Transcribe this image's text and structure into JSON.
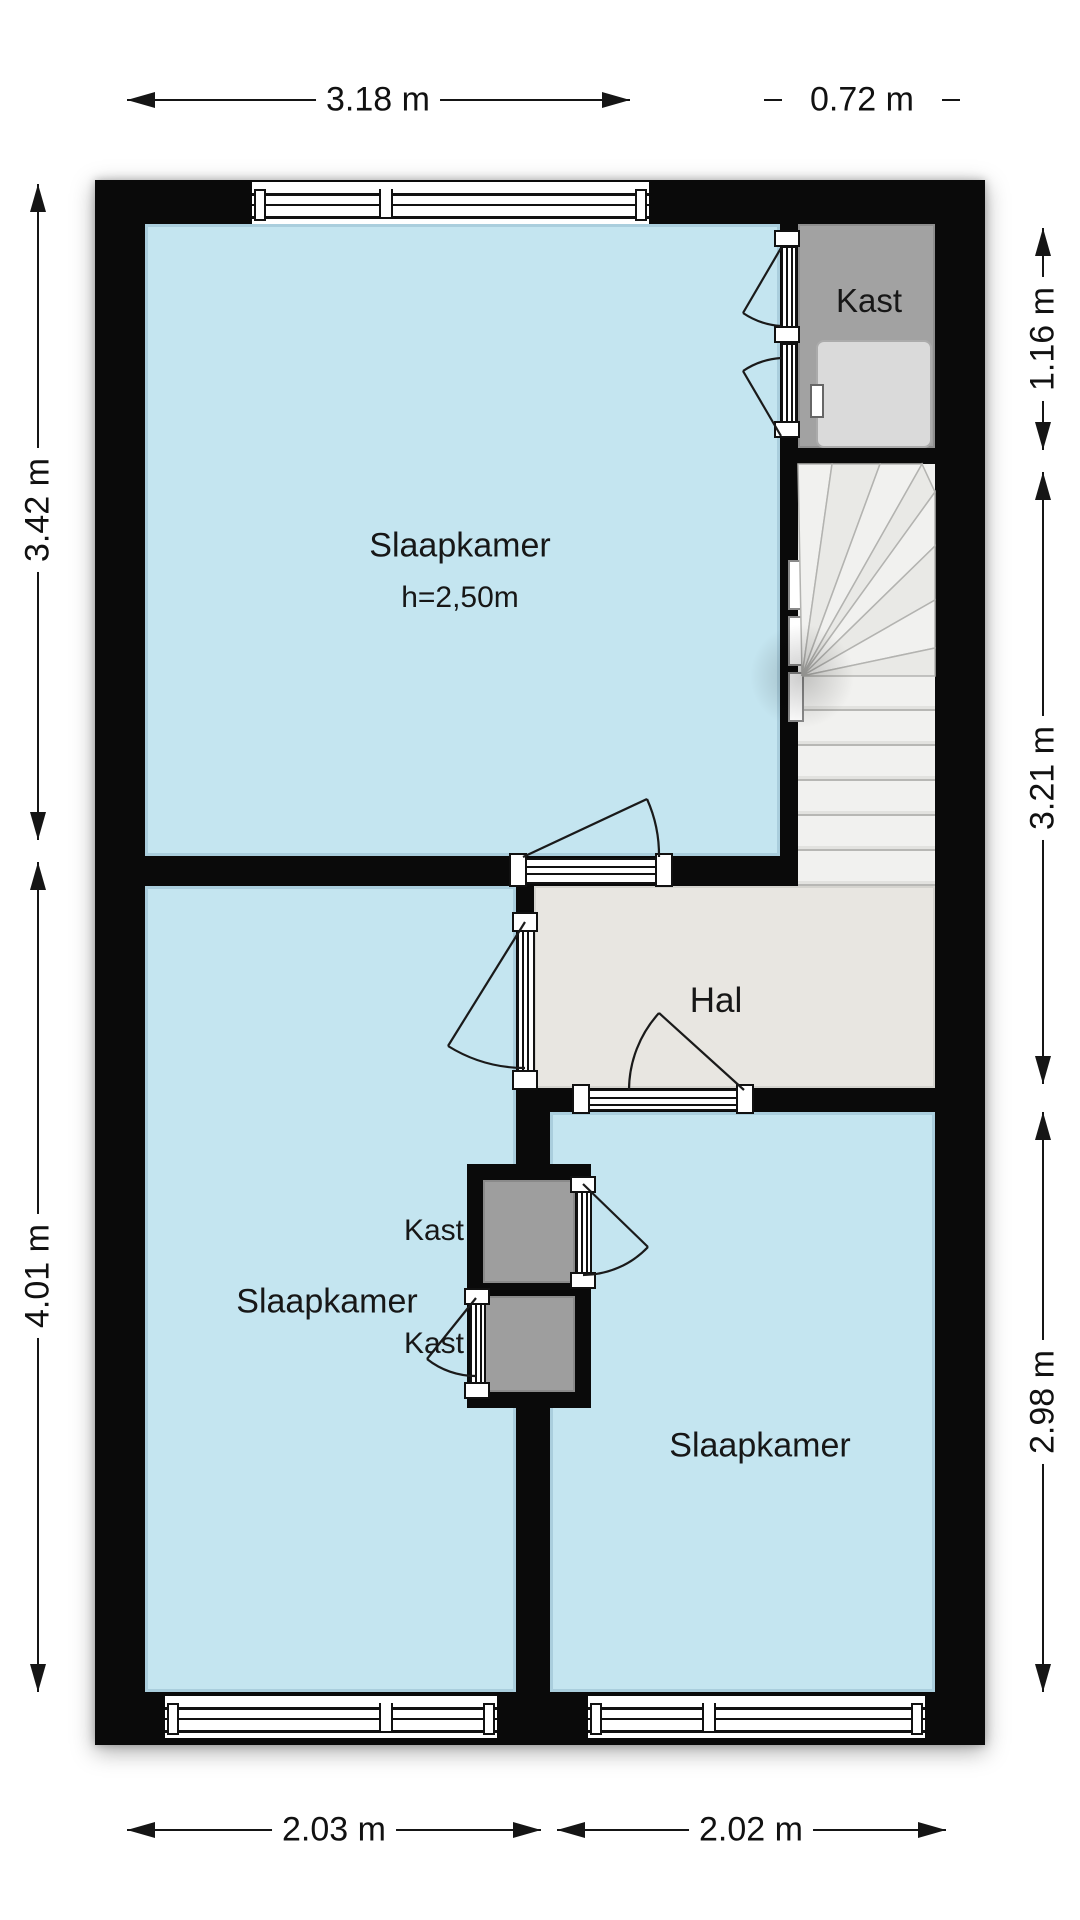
{
  "floorplan": {
    "rooms": {
      "bedroom_top": {
        "label": "Slaapkamer",
        "height_note": "h=2,50m"
      },
      "closet_top_right": {
        "label": "Kast"
      },
      "hall": {
        "label": "Hal"
      },
      "bedroom_left": {
        "label": "Slaapkamer"
      },
      "closet_middle_top": {
        "label": "Kast"
      },
      "closet_middle_bottom": {
        "label": "Kast"
      },
      "bedroom_right": {
        "label": "Slaapkamer"
      }
    },
    "dimensions": {
      "top_main": "3.18 m",
      "top_closet": "0.72 m",
      "left_upper": "3.42 m",
      "left_lower": "4.01 m",
      "right_closet": "1.16 m",
      "right_stairs": "3.21 m",
      "right_bedroom": "2.98 m",
      "bottom_left": "2.03 m",
      "bottom_right": "2.02 m"
    },
    "colors": {
      "room_fill": "#c4e5f0",
      "hall_fill": "#e8e6e1",
      "stairs_fill": "#f0f0ee",
      "closet_fill": "#a2a2a2",
      "wall": "#0a0a0a",
      "appliance_fill": "#dadada"
    }
  }
}
